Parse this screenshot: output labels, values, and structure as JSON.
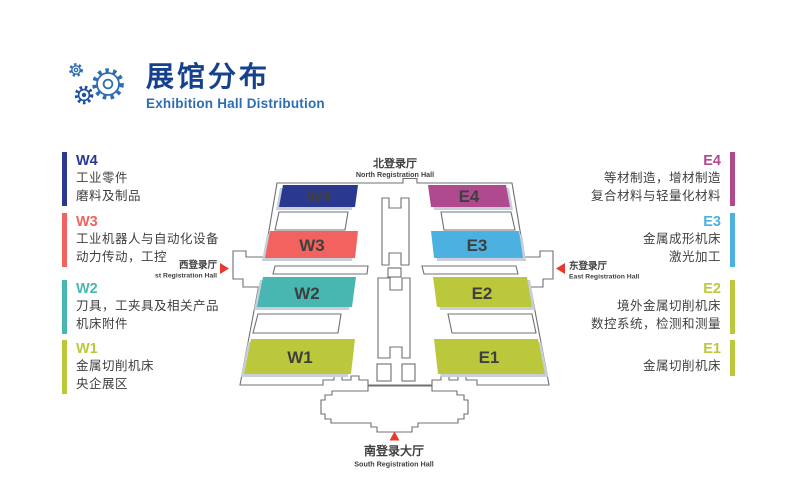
{
  "header": {
    "title": "展馆分布",
    "subtitle": "Exhibition Hall Distribution",
    "logo_icon": "gears-icon"
  },
  "colors": {
    "title_blue": "#16418f",
    "subtitle_blue": "#2e6db4",
    "logo_blue": "#2e6db4",
    "logo_dark_blue": "#1d4f9e",
    "text_dark": "#3f3f3f",
    "outline_gray": "#707074",
    "marker_red": "#e8392f",
    "hall_shadow": "#c7d0d8",
    "navy": "#2b3890",
    "coral": "#f2625e",
    "teal": "#48b7b2",
    "yellow_green": "#bcc83b",
    "magenta": "#b04a8e",
    "sky_blue": "#4cb0e1"
  },
  "legend_left": [
    {
      "code": "W4",
      "color": "#2b3890",
      "lines": [
        "工业零件",
        "磨料及制品"
      ]
    },
    {
      "code": "W3",
      "color": "#f2625e",
      "lines": [
        "工业机器人与自动化设备",
        "动力传动，工控"
      ]
    },
    {
      "code": "W2",
      "color": "#48b7b2",
      "lines": [
        "刀具，工夹具及相关产品",
        "机床附件"
      ]
    },
    {
      "code": "W1",
      "color": "#bcc83b",
      "lines": [
        "金属切削机床",
        "央企展区"
      ]
    }
  ],
  "legend_right": [
    {
      "code": "E4",
      "color": "#b04a8e",
      "lines": [
        "等材制造，增材制造",
        "复合材料与轻量化材料"
      ]
    },
    {
      "code": "E3",
      "color": "#4cb0e1",
      "lines": [
        "金属成形机床",
        "激光加工"
      ]
    },
    {
      "code": "E2",
      "color": "#bcc83b",
      "lines": [
        "境外金属切削机床",
        "数控系统，检测和测量"
      ]
    },
    {
      "code": "E1",
      "color": "#bcc83b",
      "lines": [
        "金属切削机床"
      ]
    }
  ],
  "map": {
    "halls": [
      {
        "label": "W4",
        "color": "#2b3890"
      },
      {
        "label": "W3",
        "color": "#f2625e"
      },
      {
        "label": "W2",
        "color": "#48b7b2"
      },
      {
        "label": "W1",
        "color": "#bcc83b"
      },
      {
        "label": "E4",
        "color": "#b04a8e"
      },
      {
        "label": "E3",
        "color": "#4cb0e1"
      },
      {
        "label": "E2",
        "color": "#bcc83b"
      },
      {
        "label": "E1",
        "color": "#bcc83b"
      }
    ],
    "entrances": {
      "north": {
        "zh": "北登录厅",
        "en": "North Registration Hall"
      },
      "south": {
        "zh": "南登录大厅",
        "en": "South Registration Hall"
      },
      "west": {
        "zh": "西登录厅",
        "en": "West Registration Hall"
      },
      "east": {
        "zh": "东登录厅",
        "en": "East Registration Hall"
      }
    }
  }
}
